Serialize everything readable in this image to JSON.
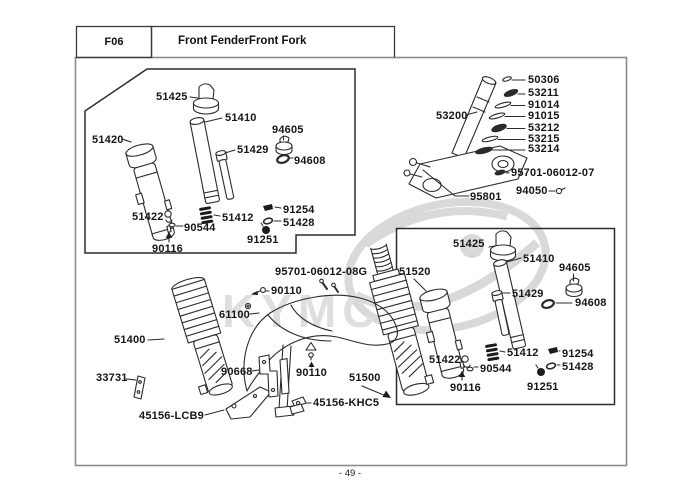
{
  "header": {
    "code": "F06",
    "title": "Front FenderFront Fork"
  },
  "footer": {
    "page_number": "- 49 -"
  },
  "watermark": {
    "brand": "KYMCO"
  },
  "parts": {
    "stack": {
      "washer_top": "50306",
      "washer_2": "53211",
      "washer_3": "91014",
      "washer_4": "91015",
      "washer_5": "53212",
      "washer_6": "53215",
      "washer_7": "53214"
    },
    "steering": {
      "stem": "53200",
      "screw": "95701-06012-07",
      "nut": "94050",
      "bolt": "95801"
    },
    "fork_left": {
      "cap": "51425",
      "inner_tube": "51410",
      "lock_nut": "94605",
      "piston_rod": "51429",
      "o_ring": "94608",
      "outer_tube": "51420",
      "circlip": "51422",
      "spring_seat": "90544",
      "rebound_spring": "51412",
      "piston": "91254",
      "piston_ring": "51428",
      "valve": "91251",
      "pin": "90116"
    },
    "fork_right": {
      "cap": "51425",
      "inner_tube": "51410",
      "lock_nut": "94605",
      "piston_rod": "51429",
      "o_ring": "94608",
      "outer_tube": "51520",
      "circlip": "51422",
      "spring_seat": "90544",
      "rebound_spring": "51412",
      "piston": "91254",
      "piston_ring": "51428",
      "valve": "91251",
      "pin": "90116"
    },
    "center": {
      "screw": "95701-06012-08G",
      "bolt_upper": "90110",
      "fender": "61100",
      "left_leg": "51400",
      "stay_bracket": "33731",
      "guard_left": "45156-LCB9",
      "fender_stay": "90668",
      "bolt_lower": "90110",
      "guard_right": "45156-KHC5",
      "right_leg": "51500"
    }
  }
}
